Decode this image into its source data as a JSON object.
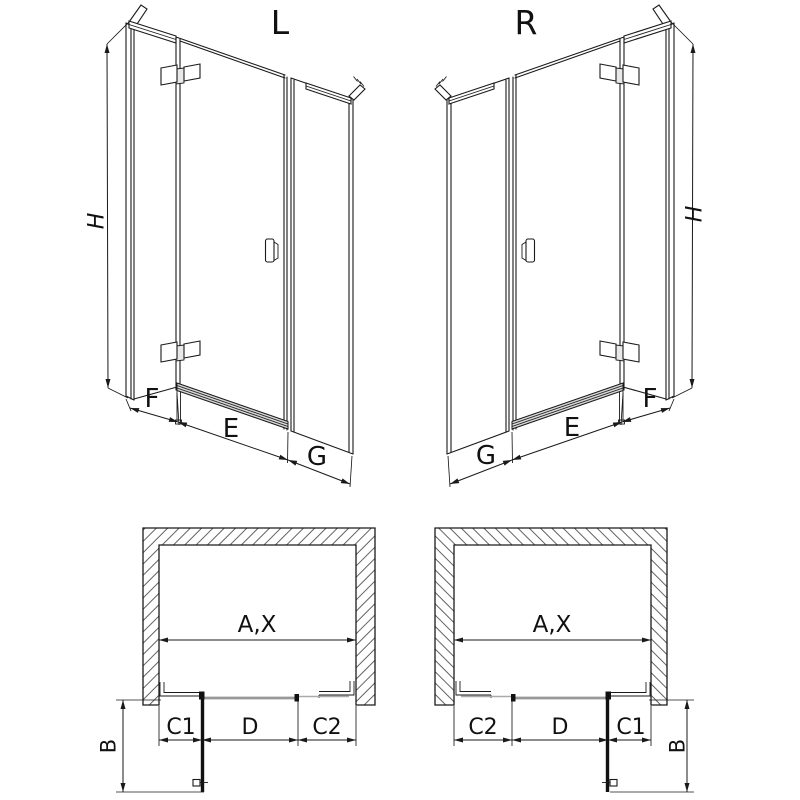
{
  "diagram": {
    "persp_left": {
      "title": "L",
      "height": "H",
      "side": "F",
      "door": "E",
      "fixed": "G"
    },
    "persp_right": {
      "title": "R",
      "height": "H",
      "side": "F",
      "door": "E",
      "fixed": "G"
    },
    "plan_left": {
      "width": "A,X",
      "seg1": "C1",
      "seg2": "D",
      "seg3": "C2",
      "depth": "B"
    },
    "plan_right": {
      "width": "A,X",
      "seg1": "C2",
      "seg2": "D",
      "seg3": "C1",
      "depth": "B"
    },
    "colors": {
      "line": "#1a1a1a",
      "glass_gray": "#999999",
      "threshold_fill": "#d6d6d6",
      "background": "#ffffff"
    }
  }
}
